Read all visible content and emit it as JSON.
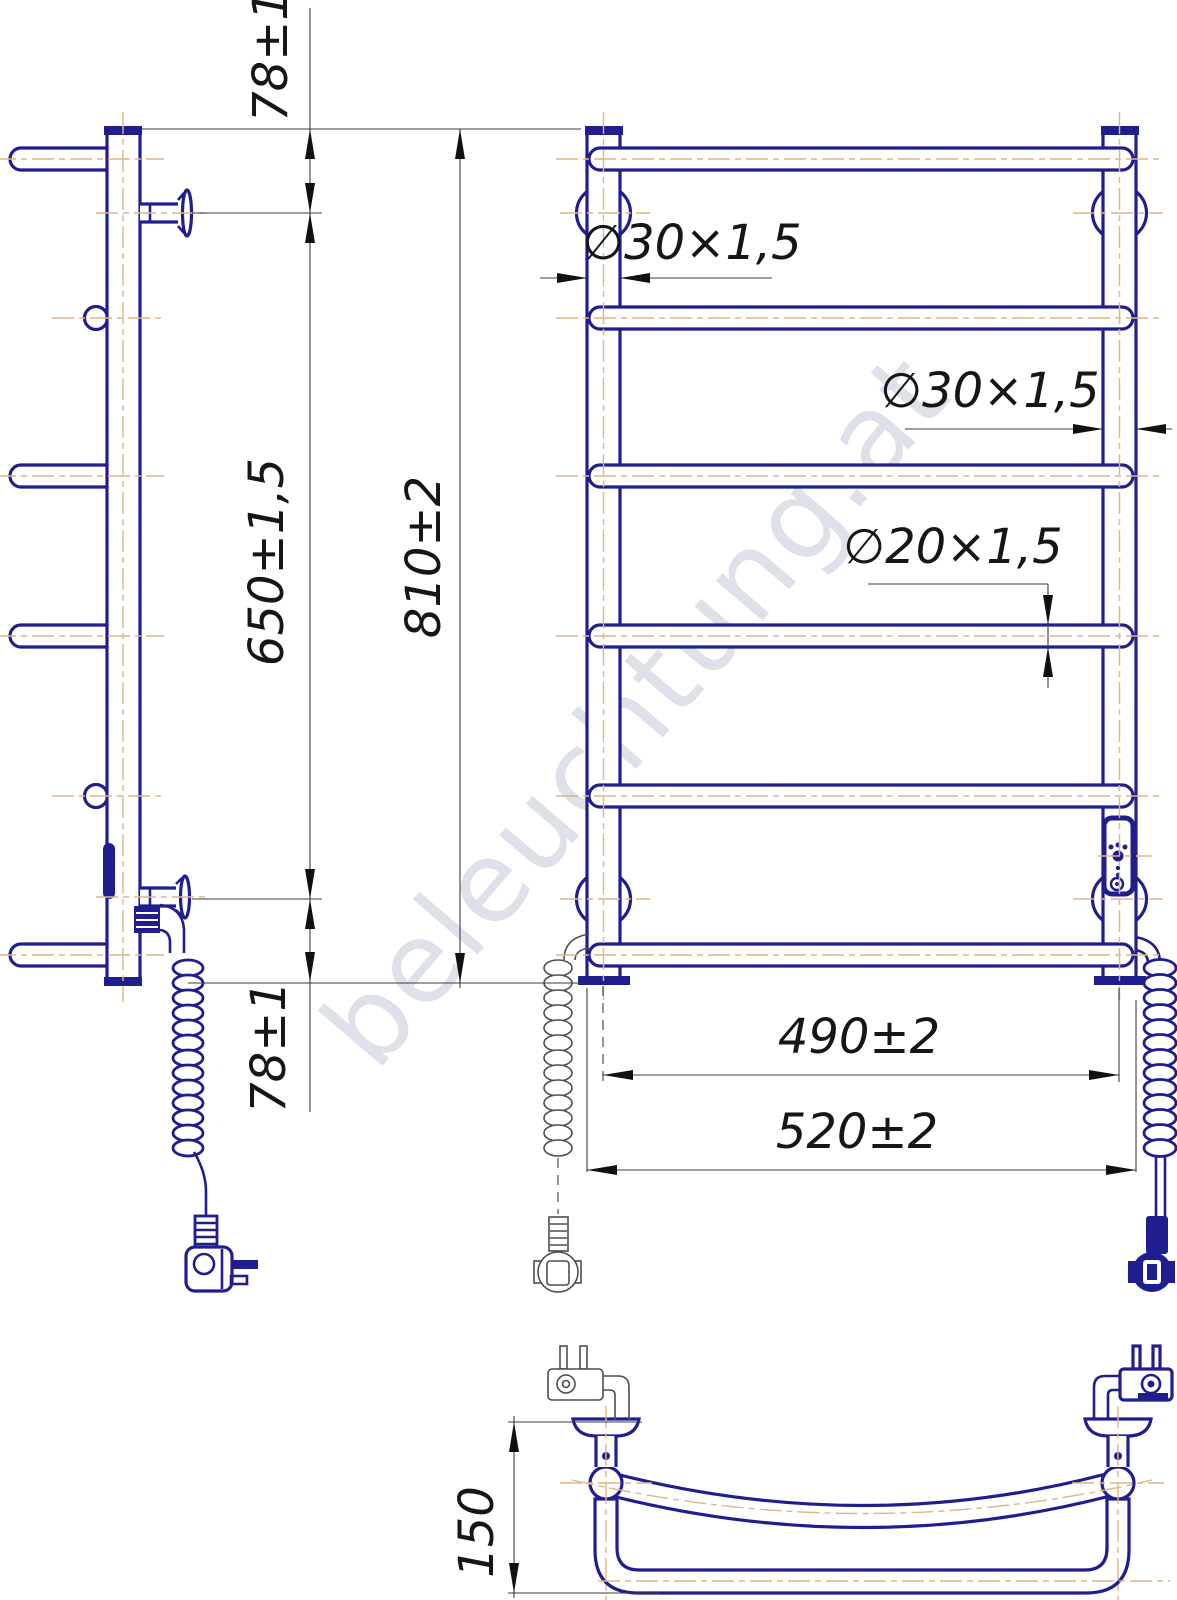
{
  "watermark": {
    "text": "beleuchtung.at"
  },
  "dimensions": {
    "side_top_offset": "78±1",
    "side_span": "650±1,5",
    "side_bottom_offset": "78±1",
    "front_height": "810±2",
    "tube_left_dia": "∅30×1,5",
    "tube_right_dia": "∅30×1,5",
    "rung_dia": "∅20×1,5",
    "rail_centers_width": "490±2",
    "rail_overall_width": "520±2",
    "depth": "150"
  },
  "colors": {
    "outline": "#201e8f",
    "centerline": "#dfb686",
    "dimension_line": "#3b3b3b",
    "label_text": "#161616",
    "watermark": "#c4cad8",
    "background": "#ffffff"
  }
}
